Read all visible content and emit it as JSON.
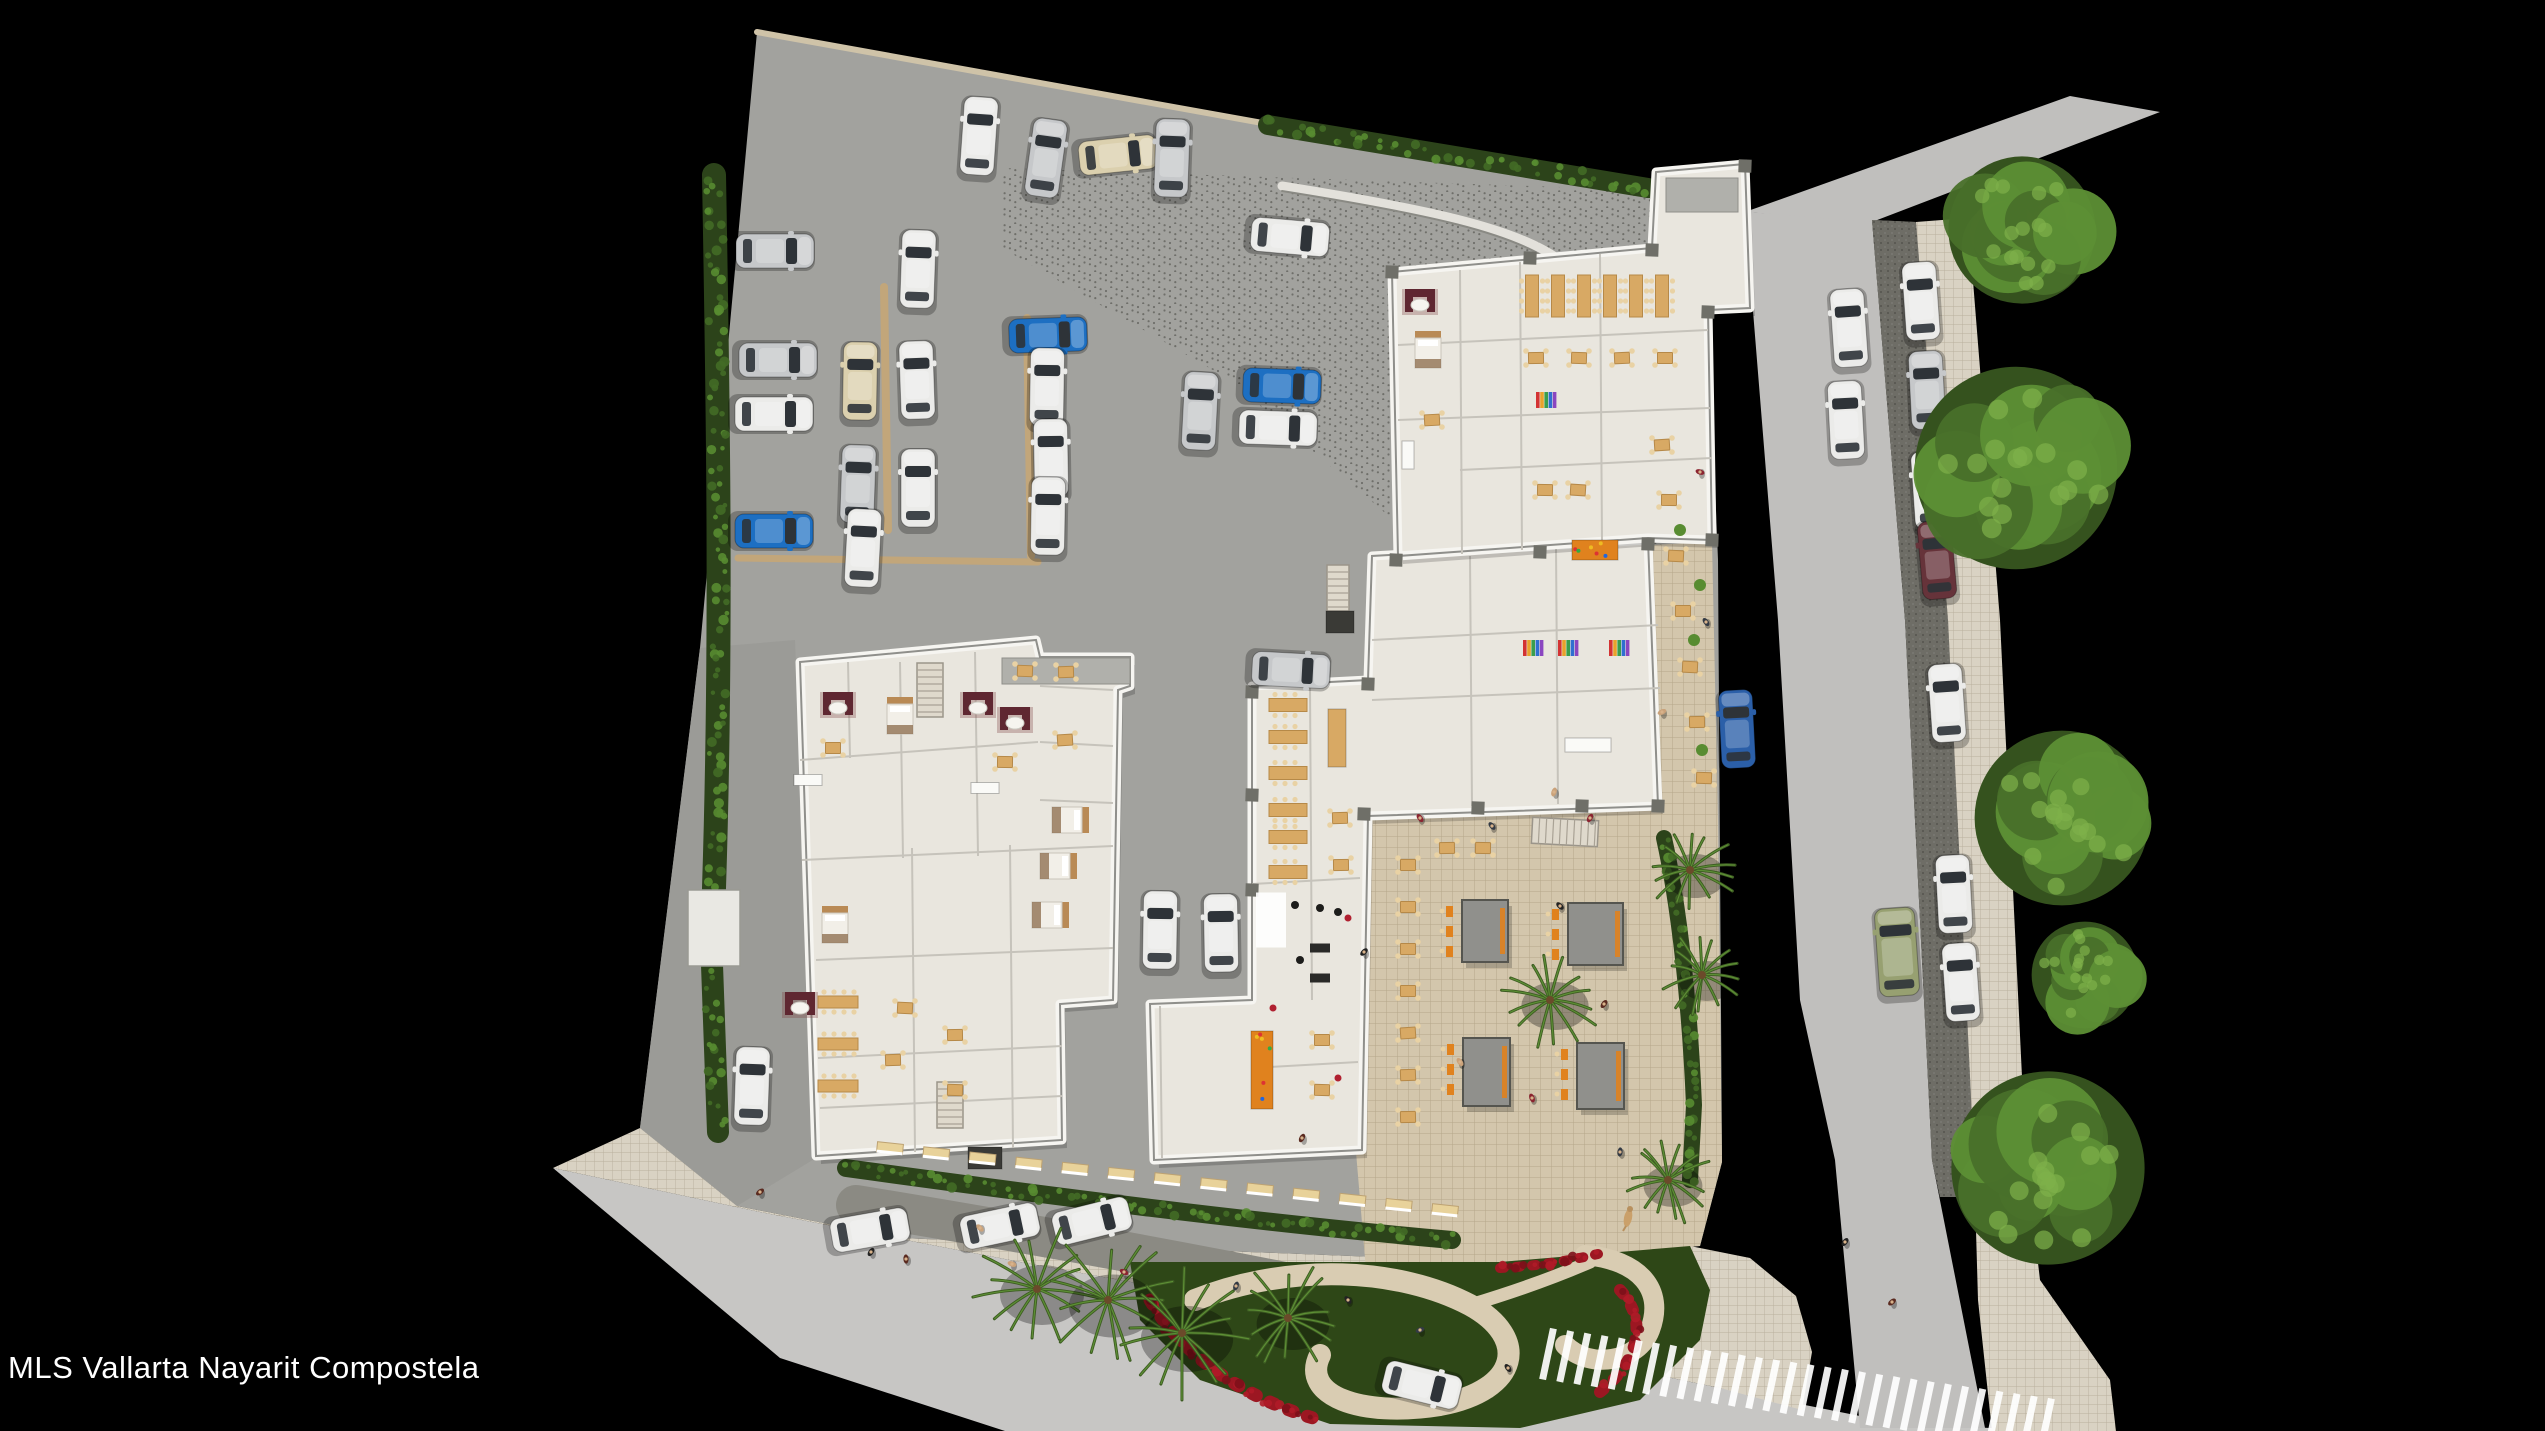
{
  "watermark": {
    "text": "MLS Vallarta Nayarit Compostela"
  },
  "canvas": {
    "w": 2545,
    "h": 1431
  },
  "colors": {
    "bg": "#000000",
    "roadB": "#c7c6c4",
    "roadR": "#c0bfbd",
    "site": "#a2a29e",
    "west": "#9b9b97",
    "paver": "#6e6d66",
    "dropoff": "#8b8a83",
    "tile": "#d9d2c3",
    "tileLine": "#b9b09c",
    "tileT": "#d3c6ac",
    "tileTLine": "#b5a78a",
    "curb": "#cfc3a8",
    "garden": "#2e4717",
    "path": "#d9ccb2",
    "flower": "#9c1722",
    "hedge": "#2c431a",
    "leaf1": "#426b26",
    "leaf2": "#588c31",
    "bldg": "#e9e6de",
    "rim": "#f6f5f1",
    "edge": "#8f8f8b",
    "room": "#c6c3bb",
    "core": "#b0b0ab",
    "column": "#6f6f68",
    "tan": "#d8a964",
    "tanEdge": "#b68948",
    "chair": "#e9d2a4",
    "orange": "#e0821e",
    "cabana": "#90908c",
    "treeD": "#35521e",
    "treeM": "#49702a",
    "treeL": "#5d8f35",
    "palm": "#3d5c22",
    "carWhite": "#ebebe9",
    "carSilver": "#c6c8ca",
    "carBeige": "#dbd0ae",
    "carBlue": "#1d6fc2",
    "carBlue2": "#2b5fa8",
    "carGreen": "#97a071",
    "carDarkred": "#66333a"
  },
  "ground": [
    {
      "n": "background",
      "pts": "0,0 2545,0 2545,1431 0,1431",
      "f": "bg"
    },
    {
      "n": "road-bottom",
      "pts": "553,1168 760,1212 1020,1262 1320,1316 1545,1352 1720,1388 1900,1424 2060,1431 1005,1431 780,1358",
      "f": "roadB"
    },
    {
      "n": "road-right",
      "pts": "1745,212 1872,220 1905,620 1932,1160 1985,1428 1860,1428 1835,1160 1800,1000 1778,620",
      "f": "roadR"
    },
    {
      "n": "road-bend-top",
      "pts": "1745,212 2070,96 2160,112 1872,222",
      "f": "roadR"
    },
    {
      "n": "parking-paver-strip",
      "pts": "1872,220 1916,222 1948,620 1974,1160 1980,1197 1940,1197 1932,1160 1905,620",
      "f": "paver",
      "pat": "pav"
    },
    {
      "n": "sidewalk-right",
      "pts": "1916,222 1968,218 2000,620 2026,1160 2040,1280 2110,1380 2116,1431 1992,1431 1978,1300 1974,1160 1948,620",
      "pat": "tileS"
    },
    {
      "n": "sidewalk-top-right",
      "pts": "1656,176 1745,165 1748,215 1662,250",
      "pat": "tileS"
    },
    {
      "n": "site-concrete",
      "pts": "757,32 1648,190 1662,250 1708,310 1718,560 1722,1162 1700,1246 1500,1262 900,1238 737,1206 640,1128 700,648",
      "f": "site"
    },
    {
      "n": "drive-speckle",
      "pts": "1002,168 1648,190 1662,252 1668,560 1440,560 1230,380 1002,248",
      "pat": "speck"
    },
    {
      "n": "west-drive",
      "pts": "700,648 795,640 816,1158 737,1206 640,1128",
      "f": "west"
    },
    {
      "n": "sidewalk-bottom",
      "pts": "640,1128 737,1206 900,1238 1500,1262 1690,1246 1750,1258 1796,1296 1812,1352 1802,1410 1720,1388 1545,1352 1320,1316 1020,1262 760,1212 553,1168",
      "pat": "tileS"
    },
    {
      "n": "dropoff-lane",
      "d": "M856,1205 C1100,1245 1350,1292 1556,1340",
      "stroke": "dropoff",
      "w": 40
    },
    {
      "n": "terrace",
      "pts": "1652,545 1712,542 1718,820 1722,1162 1700,1246 1500,1262 1366,1270 1356,1152 1362,816 1658,800",
      "pat": "tileT"
    },
    {
      "n": "garden",
      "pts": "1130,1262 1500,1262 1690,1246 1710,1290 1700,1340 1640,1400 1520,1428 1330,1424 1200,1380 1140,1320",
      "f": "garden"
    }
  ],
  "strokes": [
    {
      "n": "garden-path-loop",
      "d": "M1195,1300 C1290,1262 1400,1268 1470,1305 C1530,1338 1520,1390 1440,1405 C1360,1418 1300,1395 1320,1355",
      "c": "path",
      "w": 22
    },
    {
      "n": "garden-path-loop2",
      "d": "M1585,1255 C1640,1260 1665,1290 1650,1330 C1638,1362 1590,1370 1565,1345",
      "c": "path",
      "w": 20
    },
    {
      "n": "garden-path-spur",
      "d": "M1470,1305 C1520,1290 1560,1275 1590,1262",
      "c": "path",
      "w": 13
    },
    {
      "n": "flowers-1",
      "d": "M1150,1300 C1180,1352 1240,1398 1320,1420",
      "c": "flower",
      "w": 13,
      "dash": "5 15",
      "leaf": [
        "#b01b28",
        "#7d1019"
      ]
    },
    {
      "n": "flowers-2",
      "d": "M1620,1290 C1648,1320 1640,1360 1600,1392",
      "c": "flower",
      "w": 12,
      "dash": "5 14",
      "leaf": [
        "#b01b28",
        "#7d1019"
      ]
    },
    {
      "n": "flowers-3",
      "d": "M1500,1268 C1540,1266 1572,1260 1598,1254",
      "c": "flower",
      "w": 10,
      "dash": "4 12",
      "leaf": [
        "#b01b28",
        "#7d1019"
      ]
    },
    {
      "n": "curb-top",
      "d": "M757,32 L1268,124",
      "c": "curb",
      "w": 6
    },
    {
      "n": "parking-divider-1",
      "d": "M738,558 L1038,562",
      "c": "#c2a67a",
      "w": 7
    },
    {
      "n": "parking-divider-2",
      "d": "M1027,318 L1031,556",
      "c": "#c2a67a",
      "w": 8
    },
    {
      "n": "parking-divider-3",
      "d": "M884,287 L888,530",
      "c": "#c2a67a",
      "w": 8
    },
    {
      "n": "drive-wall-light",
      "d": "M1282,186 C1420,208 1520,228 1562,262 C1598,292 1610,350 1612,425",
      "c": "#e3e1db",
      "w": 9
    },
    {
      "n": "drive-wall-dark",
      "d": "M1282,191 C1420,213 1520,233 1558,267 C1594,297 1605,352 1607,425",
      "c": "#8a8a84",
      "w": 2
    },
    {
      "n": "hedge-left-1",
      "d": "M714,175 C718,400 722,640 714,888",
      "c": "hedge",
      "w": 24,
      "leafy": 1
    },
    {
      "n": "hedge-left-2",
      "d": "M712,965 L718,1132",
      "c": "hedge",
      "w": 22,
      "leafy": 1
    },
    {
      "n": "hedge-top",
      "d": "M1268,125 L1648,188",
      "c": "hedge",
      "w": 20,
      "leafy": 1
    },
    {
      "n": "hedge-south",
      "d": "M846,1168 C1050,1196 1250,1222 1452,1240",
      "c": "hedge",
      "w": 18,
      "leafy": 1
    },
    {
      "n": "hedge-terrace-east",
      "d": "M1664,838 C1680,910 1690,1010 1694,1105 L1690,1180",
      "c": "hedge",
      "w": 16,
      "leafy": 1
    },
    {
      "n": "terrace-north-wall",
      "d": "M1362,816 L1658,800",
      "c": "edge",
      "w": 3
    }
  ],
  "walls": [
    [
      688,
      890,
      52,
      76
    ]
  ],
  "buildings": [
    {
      "n": "building-residential",
      "pts": "800,662 1036,640 1040,657 1130,657 1130,686 1118,690 1113,1000 1060,1004 1062,1140 816,1156",
      "rooms": [
        "M800,760 L1038,742",
        "M802,860 L1113,846",
        "M816,960 L1113,948",
        "M818,1058 L1062,1046",
        "M900,662 L903,858",
        "M975,652 L978,856",
        "M1040,686 L1113,690",
        "M912,848 L915,1152",
        "M1010,845 L1013,1148",
        "M848,662 L850,758",
        "M1040,742 L1113,746",
        "M1040,800 L1113,803",
        "M820,1108 L1062,1096"
      ],
      "cores": [
        [
          1002,
          658,
          128,
          26
        ]
      ]
    },
    {
      "n": "building-amenities",
      "pts": "1252,686 1368,680 1372,556 1648,540 1658,806 1368,816 1362,1150 1154,1160 1150,1004 1252,1000",
      "rooms": [
        "M1310,686 L1312,1000",
        "M1252,884 L1360,878",
        "M1372,640 L1658,625",
        "M1372,700 L1660,688",
        "M1470,556 L1472,806",
        "M1556,548 L1558,804",
        "M1252,1068 L1358,1062",
        "M1160,1006 L1162,1158"
      ],
      "cores": []
    },
    {
      "n": "building-restaurant",
      "pts": "1392,272 1652,248 1656,172 1745,164 1750,308 1708,310 1712,540 1648,538 1398,556",
      "rooms": [
        "M1460,270 L1462,554",
        "M1520,262 L1522,550",
        "M1600,254 L1602,542",
        "M1398,345 L1708,330",
        "M1398,420 L1710,408",
        "M1460,470 L1712,458"
      ],
      "cores": [
        [
          1666,
          178,
          72,
          34
        ]
      ]
    }
  ],
  "columns": [
    [
      1396,
      560
    ],
    [
      1540,
      552
    ],
    [
      1648,
      544
    ],
    [
      1364,
      814
    ],
    [
      1478,
      808
    ],
    [
      1582,
      806
    ],
    [
      1658,
      806
    ],
    [
      1392,
      272
    ],
    [
      1530,
      258
    ],
    [
      1652,
      250
    ],
    [
      1745,
      166
    ],
    [
      1252,
      692
    ],
    [
      1252,
      795
    ],
    [
      1252,
      890
    ],
    [
      1368,
      684
    ],
    [
      1708,
      312
    ],
    [
      1712,
      540
    ]
  ],
  "stairs": [
    [
      930,
      690,
      26,
      54,
      0
    ],
    [
      950,
      1105,
      26,
      46,
      0
    ],
    [
      1338,
      588,
      22,
      46,
      0
    ],
    [
      1565,
      832,
      66,
      26,
      3
    ]
  ],
  "counters": [
    [
      1337,
      738,
      18,
      58,
      "tan"
    ],
    [
      1262,
      1070,
      22,
      78,
      "orange"
    ],
    [
      1595,
      550,
      46,
      20,
      "orange"
    ],
    [
      1588,
      745,
      46,
      14,
      "white"
    ],
    [
      985,
      1158,
      34,
      22,
      "dark"
    ],
    [
      1340,
      622,
      28,
      22,
      "dark"
    ],
    [
      1408,
      455,
      12,
      28,
      "white"
    ],
    [
      808,
      780,
      28,
      11,
      "white"
    ],
    [
      985,
      788,
      28,
      11,
      "white"
    ]
  ],
  "shelves": [
    [
      1533,
      648
    ],
    [
      1568,
      648
    ],
    [
      1619,
      648
    ],
    [
      1546,
      400
    ]
  ],
  "gym": {
    "mats": [
      [
        1271,
        920,
        30,
        55
      ]
    ],
    "black": [
      [
        1295,
        905
      ],
      [
        1320,
        908
      ],
      [
        1338,
        912
      ],
      [
        1300,
        960
      ]
    ],
    "tread": [
      [
        1320,
        948
      ],
      [
        1320,
        978
      ]
    ],
    "red": [
      [
        1348,
        918
      ],
      [
        1273,
        1008
      ],
      [
        1338,
        1078
      ]
    ]
  },
  "beds": [
    [
      900,
      716,
      0
    ],
    [
      1070,
      820,
      90
    ],
    [
      1058,
      866,
      90
    ],
    [
      1050,
      915,
      90
    ],
    [
      835,
      925,
      0
    ],
    [
      1428,
      350,
      0
    ]
  ],
  "sofas": [
    [
      838,
      705
    ],
    [
      978,
      705
    ],
    [
      1015,
      720
    ],
    [
      800,
      1005
    ],
    [
      1420,
      302
    ]
  ],
  "tablesSm": [
    [
      1408,
      865
    ],
    [
      1408,
      907
    ],
    [
      1408,
      949
    ],
    [
      1408,
      991
    ],
    [
      1408,
      1033
    ],
    [
      1408,
      1075
    ],
    [
      1408,
      1117
    ],
    [
      1447,
      848
    ],
    [
      1483,
      848
    ],
    [
      1662,
      445
    ],
    [
      1669,
      500
    ],
    [
      1676,
      556
    ],
    [
      1683,
      611
    ],
    [
      1690,
      667
    ],
    [
      1697,
      722
    ],
    [
      1704,
      778
    ],
    [
      1340,
      818
    ],
    [
      1341,
      865
    ],
    [
      1536,
      358
    ],
    [
      1579,
      358
    ],
    [
      1622,
      358
    ],
    [
      1665,
      358
    ],
    [
      1545,
      490
    ],
    [
      1578,
      490
    ],
    [
      1322,
      1040
    ],
    [
      1322,
      1090
    ],
    [
      893,
      1060
    ],
    [
      955,
      1035
    ],
    [
      955,
      1090
    ],
    [
      1025,
      671
    ],
    [
      1066,
      672
    ],
    [
      833,
      748
    ],
    [
      1005,
      762
    ],
    [
      1065,
      740
    ],
    [
      905,
      1008
    ],
    [
      1432,
      420
    ]
  ],
  "longTables": [
    [
      1532,
      296,
      13,
      42
    ],
    [
      1558,
      296,
      13,
      42
    ],
    [
      1584,
      296,
      13,
      42
    ],
    [
      1610,
      296,
      13,
      42
    ],
    [
      1636,
      296,
      13,
      42
    ],
    [
      1662,
      296,
      13,
      42
    ],
    [
      1288,
      705,
      38,
      13
    ],
    [
      1288,
      737,
      38,
      13
    ],
    [
      1288,
      773,
      38,
      13
    ],
    [
      1288,
      810,
      38,
      13
    ],
    [
      1288,
      837,
      38,
      13
    ],
    [
      1288,
      872,
      38,
      13
    ],
    [
      838,
      1002,
      40,
      12
    ],
    [
      838,
      1044,
      40,
      12
    ],
    [
      838,
      1086,
      40,
      12
    ]
  ],
  "cabanas": [
    [
      1462,
      900,
      46,
      62
    ],
    [
      1568,
      903,
      55,
      62
    ],
    [
      1463,
      1038,
      47,
      68
    ],
    [
      1577,
      1043,
      47,
      66
    ]
  ],
  "awnings": {
    "x1": 890,
    "y1": 1148,
    "x2": 1445,
    "y2": 1210,
    "count": 13
  },
  "crosswalk": {
    "x1": 1548,
    "y1": 1354,
    "x2": 2046,
    "y2": 1424,
    "count": 30,
    "len": 52,
    "wid": 7,
    "tilt": 12
  },
  "trees": [
    [
      2022,
      230,
      80
    ],
    [
      2016,
      468,
      110
    ],
    [
      2062,
      818,
      95
    ],
    [
      2085,
      975,
      58
    ],
    [
      2048,
      1168,
      105
    ]
  ],
  "palms": [
    [
      1550,
      1000,
      48
    ],
    [
      1037,
      1289,
      60
    ],
    [
      1108,
      1300,
      63
    ],
    [
      1182,
      1333,
      66
    ],
    [
      1288,
      1318,
      52
    ],
    [
      1690,
      870,
      44
    ],
    [
      1702,
      975,
      40
    ],
    [
      1668,
      1180,
      42
    ]
  ],
  "shrubs": [
    [
      1680,
      530
    ],
    [
      1694,
      640
    ],
    [
      1702,
      750
    ],
    [
      1700,
      585
    ]
  ],
  "cars": [
    [
      775,
      251,
      90,
      "silver"
    ],
    [
      778,
      360,
      90,
      "silver"
    ],
    [
      774,
      414,
      90,
      "white"
    ],
    [
      774,
      531,
      90,
      "blue"
    ],
    [
      918,
      269,
      2,
      "white"
    ],
    [
      860,
      381,
      1,
      "beige"
    ],
    [
      917,
      380,
      358,
      "white"
    ],
    [
      858,
      484,
      2,
      "silver"
    ],
    [
      918,
      488,
      0,
      "white"
    ],
    [
      863,
      548,
      3,
      "white"
    ],
    [
      1048,
      335,
      88,
      "blue"
    ],
    [
      1047,
      387,
      1,
      "white"
    ],
    [
      1051,
      458,
      359,
      "white"
    ],
    [
      1048,
      516,
      1,
      "white"
    ],
    [
      1118,
      155,
      84,
      "beige"
    ],
    [
      979,
      136,
      4,
      "white"
    ],
    [
      1046,
      158,
      8,
      "silver"
    ],
    [
      1172,
      158,
      2,
      "silver"
    ],
    [
      1290,
      237,
      95,
      "white"
    ],
    [
      1282,
      386,
      92,
      "blue"
    ],
    [
      1200,
      411,
      3,
      "silver"
    ],
    [
      1278,
      428,
      92,
      "white"
    ],
    [
      1291,
      670,
      93,
      "silver"
    ],
    [
      1160,
      930,
      1,
      "white"
    ],
    [
      1221,
      933,
      359,
      "white"
    ],
    [
      752,
      1086,
      2,
      "white"
    ],
    [
      870,
      1230,
      80,
      "white"
    ],
    [
      1000,
      1226,
      78,
      "white"
    ],
    [
      1092,
      1221,
      76,
      "white"
    ],
    [
      1422,
      1385,
      104,
      "white"
    ],
    [
      1737,
      729,
      357,
      "blue2"
    ],
    [
      1897,
      952,
      356,
      "green",
      1
    ],
    [
      1849,
      328,
      356,
      "white"
    ],
    [
      1846,
      420,
      357,
      "white"
    ],
    [
      1921,
      301,
      356,
      "white"
    ],
    [
      1927,
      390,
      357,
      "silver"
    ],
    [
      1930,
      490,
      356,
      "white"
    ],
    [
      1937,
      560,
      355,
      "darkred"
    ],
    [
      1947,
      703,
      356,
      "white"
    ],
    [
      1954,
      894,
      357,
      "white"
    ],
    [
      1961,
      982,
      356,
      "white"
    ]
  ],
  "people": [
    [
      871,
      1252
    ],
    [
      906,
      1259
    ],
    [
      1012,
      1264
    ],
    [
      1124,
      1272
    ],
    [
      1236,
      1286
    ],
    [
      1348,
      1300
    ],
    [
      760,
      1192
    ],
    [
      980,
      1228
    ],
    [
      1420,
      818
    ],
    [
      1492,
      826
    ],
    [
      1560,
      906
    ],
    [
      1604,
      1004
    ],
    [
      1662,
      712
    ],
    [
      1700,
      472
    ],
    [
      1706,
      622
    ],
    [
      1845,
      1242
    ],
    [
      1892,
      1302
    ],
    [
      1460,
      1062
    ],
    [
      1532,
      1098
    ],
    [
      1620,
      1152
    ],
    [
      1364,
      952
    ],
    [
      1302,
      1138
    ],
    [
      1554,
      792
    ],
    [
      1590,
      818
    ],
    [
      1420,
      1330
    ],
    [
      1508,
      1368
    ]
  ],
  "dogs": [
    [
      1628,
      1218
    ]
  ]
}
